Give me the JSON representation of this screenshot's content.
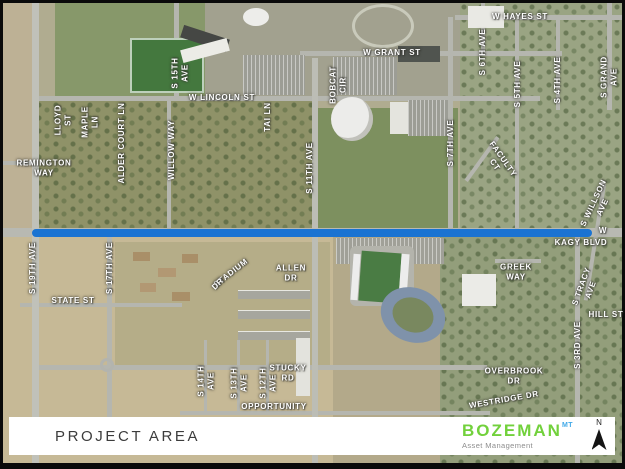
{
  "footer": {
    "title": "PROJECT AREA",
    "brand": {
      "name": "BOZEMAN",
      "state": "MT",
      "tagline": "Asset Management",
      "name_color": "#72d13c",
      "state_color": "#41a9e8",
      "tagline_color": "#8d8d8d"
    },
    "north": {
      "label": "N"
    }
  },
  "project_line": {
    "color": "#1a73d2"
  },
  "map": {
    "labels": [
      {
        "text": "W HAYES ST",
        "x": 520,
        "y": 17,
        "rot": 0
      },
      {
        "text": "W GRANT ST",
        "x": 392,
        "y": 53,
        "rot": 0
      },
      {
        "text": "W LINCOLN ST",
        "x": 222,
        "y": 98,
        "rot": 0
      },
      {
        "lines": [
          "REMINGTON",
          "WAY"
        ],
        "x": 44,
        "y": 168,
        "rot": 0
      },
      {
        "text": "W",
        "x": 603,
        "y": 231,
        "rot": 0
      },
      {
        "text": "KAGY BLVD",
        "x": 581,
        "y": 243,
        "rot": 0
      },
      {
        "text": "STATE ST",
        "x": 73,
        "y": 301,
        "rot": 0
      },
      {
        "lines": [
          "ALLEN",
          "DR"
        ],
        "x": 291,
        "y": 273,
        "rot": 0
      },
      {
        "text": "STADIUM",
        "x": 231,
        "y": 273,
        "rot": -38
      },
      {
        "text": "DR",
        "x": 218,
        "y": 284,
        "rot": -45
      },
      {
        "lines": [
          "STUCKY",
          "RD"
        ],
        "x": 288,
        "y": 373,
        "rot": 0
      },
      {
        "text": "OPPORTUNITY",
        "x": 274,
        "y": 407,
        "rot": 0
      },
      {
        "lines": [
          "GREEK",
          "WAY"
        ],
        "x": 516,
        "y": 272,
        "rot": 0
      },
      {
        "lines": [
          "OVERBROOK",
          "DR"
        ],
        "x": 514,
        "y": 376,
        "rot": 0
      },
      {
        "text": "WESTRIDGE DR",
        "x": 504,
        "y": 400,
        "rot": -10
      },
      {
        "text": "HILL ST",
        "x": 606,
        "y": 315,
        "rot": 0
      },
      {
        "lines": [
          "S 15TH",
          "AVE"
        ],
        "x": 180,
        "y": 73,
        "rot": -90
      },
      {
        "text": "S 11TH AVE",
        "x": 310,
        "y": 168,
        "rot": -90
      },
      {
        "text": "TAI LN",
        "x": 268,
        "y": 117,
        "rot": -90
      },
      {
        "lines": [
          "LLOYD",
          "ST"
        ],
        "x": 63,
        "y": 120,
        "rot": -90
      },
      {
        "lines": [
          "MAPLE",
          "LN"
        ],
        "x": 90,
        "y": 122,
        "rot": -90
      },
      {
        "text": "ALDER COURT LN",
        "x": 122,
        "y": 143,
        "rot": -90
      },
      {
        "text": "WILLOW WAY",
        "x": 172,
        "y": 150,
        "rot": -90
      },
      {
        "text": "S 6TH AVE",
        "x": 483,
        "y": 52,
        "rot": -90
      },
      {
        "text": "S 5TH AVE",
        "x": 518,
        "y": 84,
        "rot": -90
      },
      {
        "text": "S 4TH AVE",
        "x": 558,
        "y": 80,
        "rot": -90
      },
      {
        "lines": [
          "S GRAND",
          "AVE"
        ],
        "x": 609,
        "y": 77,
        "rot": -90
      },
      {
        "text": "S 7TH AVE",
        "x": 451,
        "y": 143,
        "rot": -90
      },
      {
        "lines": [
          "BOBCAT",
          "CIR"
        ],
        "x": 338,
        "y": 85,
        "rot": -90
      },
      {
        "lines": [
          "FACULTY",
          "CT"
        ],
        "x": 499,
        "y": 162,
        "rot": 55
      },
      {
        "lines": [
          "S WILLSON",
          "AVE"
        ],
        "x": 598,
        "y": 205,
        "rot": -65
      },
      {
        "lines": [
          "S TRACY",
          "AVE"
        ],
        "x": 586,
        "y": 288,
        "rot": -70
      },
      {
        "text": "S 3RD AVE",
        "x": 578,
        "y": 345,
        "rot": -90
      },
      {
        "lines": [
          "S 14TH",
          "AVE"
        ],
        "x": 206,
        "y": 381,
        "rot": -90
      },
      {
        "lines": [
          "S 13TH",
          "AVE"
        ],
        "x": 239,
        "y": 383,
        "rot": -90
      },
      {
        "lines": [
          "S 12TH",
          "AVE"
        ],
        "x": 268,
        "y": 383,
        "rot": -90
      },
      {
        "text": "S 17TH AVE",
        "x": 110,
        "y": 268,
        "rot": -90
      },
      {
        "text": "S 19TH AVE",
        "x": 33,
        "y": 268,
        "rot": -90
      }
    ]
  }
}
